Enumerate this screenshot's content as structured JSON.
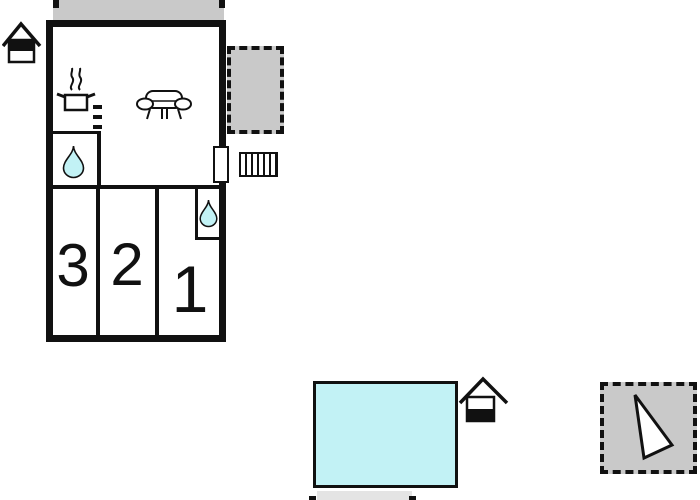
{
  "plan": {
    "type": "vacation-house-floor-plan",
    "rooms": [
      {
        "id": "room-3",
        "number": "3"
      },
      {
        "id": "room-2",
        "number": "2"
      },
      {
        "id": "room-1",
        "number": "1"
      }
    ],
    "icons": {
      "hut_north": "hut-icon",
      "hut_pool": "hut-icon",
      "stove": "stove-icon",
      "sofa": "sofa-icon",
      "drop_bathroom": "water-drop-icon",
      "drop_wc": "water-drop-icon",
      "stairs": "stairs-icon",
      "door": "door-marker",
      "north_arrow": "north-arrow-icon"
    },
    "areas": {
      "north_terrace": "terrace-strip",
      "side_terrace": "dashed-terrace",
      "pool": "swimming-pool",
      "pool_path": "path-strip",
      "compass": "orientation-box"
    }
  },
  "colors": {
    "wall": "#111111",
    "terrace": "#c9c9c9",
    "path": "#e4e4e4",
    "water": "#c2f2f5",
    "paper": "#ffffff"
  }
}
